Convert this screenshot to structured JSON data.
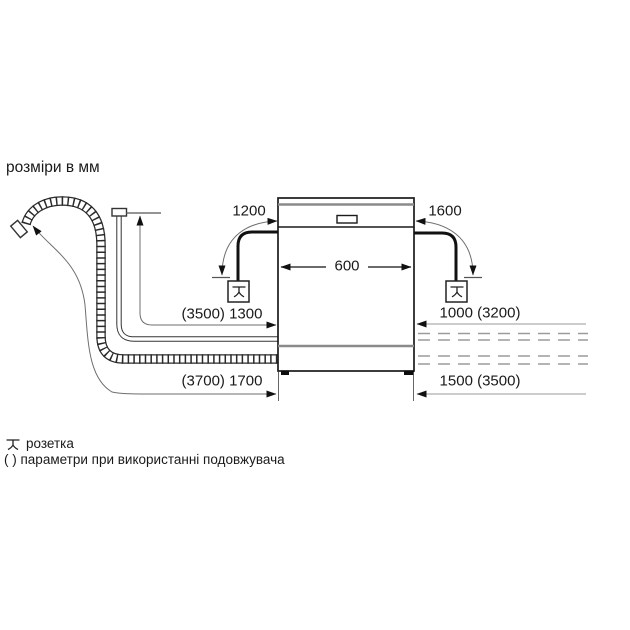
{
  "title": "розміри в мм",
  "dimensions": {
    "power_cord_left": "1200",
    "power_cord_right": "1600",
    "appliance_width": "600",
    "supply_hose_left": "(3500) 1300",
    "drain_hose_left": "(3700) 1700",
    "supply_hose_right": "1000 (3200)",
    "drain_hose_right": "1500 (3500)"
  },
  "legend": {
    "socket_label": "розетка",
    "note": "( ) параметри при використанні подовжувача"
  },
  "icons": {
    "socket": "power-socket-icon",
    "drain_hose": "corrugated-drain-hose",
    "supply_hose": "water-supply-hose"
  },
  "colors": {
    "line": "#1a1a1a",
    "thin_leader": "#6e6e6e",
    "gray_panel_line": "#8a8a8a",
    "dashed_extension": "#9b9b9b",
    "background": "#ffffff"
  }
}
